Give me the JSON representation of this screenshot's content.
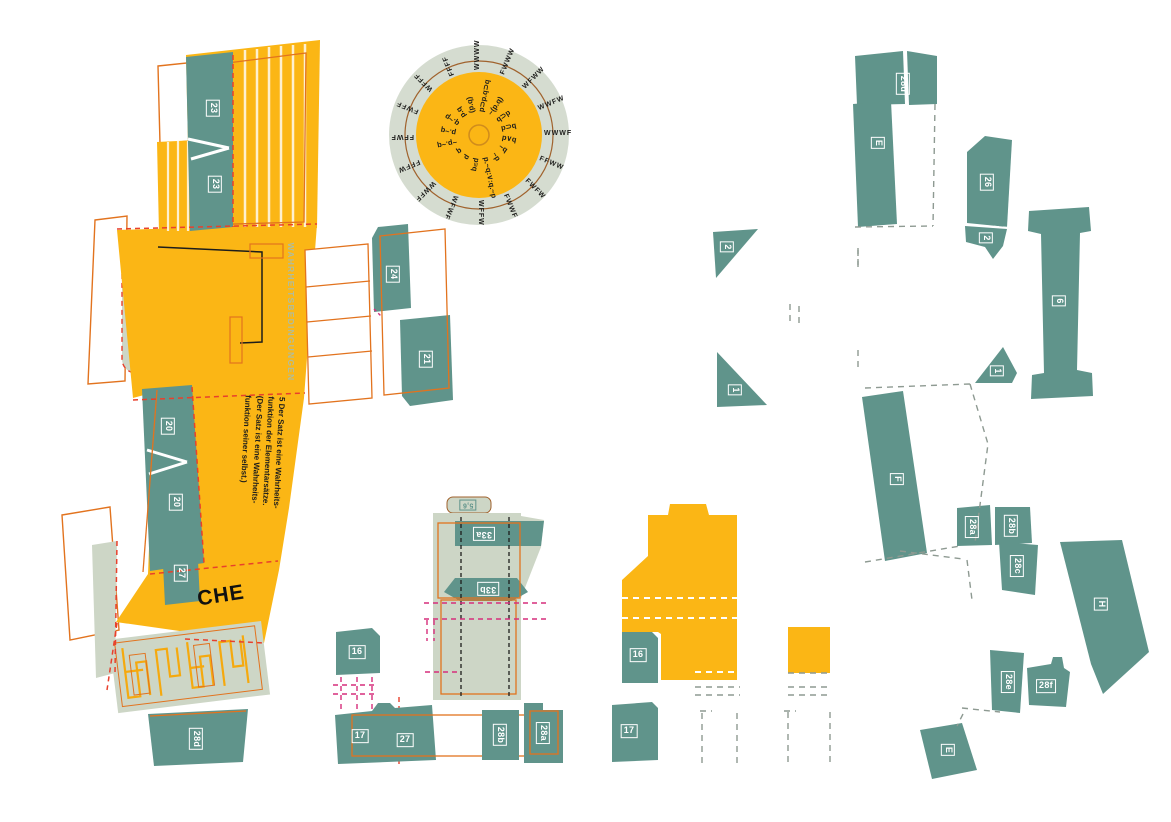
{
  "palette": {
    "yellow": "#FBB615",
    "teal": "#60948B",
    "sage_light": "#CDD6C6",
    "disc_sage": "#D5DCD0",
    "orange_line": "#E2731E",
    "red_dash": "#E8402C",
    "magenta_dash": "#D62E7B",
    "brown_ring": "#A0622D",
    "gray_dash": "#8E9A92",
    "black": "#1D1D1B"
  },
  "left_assembly": {
    "tab_23_top": "23",
    "tab_23_bottom": "23",
    "tab_24": "24",
    "tab_21": "21",
    "tab_20_top": "20",
    "tab_20_bottom": "20",
    "tab_27": "27",
    "tab_28d": "28d",
    "vertical_label": "WAHRHEITSBEDINGUNGEN",
    "fragment_text": "CHE",
    "tractatus_lines": [
      "5   Der Satz ist eine Wahrheits-",
      "funktion der Elementarsätze.",
      "(Der Satz ist eine Wahrheits-",
      "funktion seiner selbst.)"
    ]
  },
  "disc": {
    "ring_values": [
      "WWWW",
      "FWWW",
      "WFWW",
      "WWFW",
      "WWWF",
      "FFWW",
      "FWFW",
      "FWWF",
      "WFFW",
      "WFWF",
      "WWFF",
      "FFFW",
      "FFWF",
      "FWFF",
      "WFFF",
      "FFFF"
    ],
    "formulas": [
      "p⊃p.q⊃q",
      "~(p.q)",
      "q⊃p",
      "p⊃q",
      "p∨q",
      "~q",
      "~p",
      "p.~q:∨:q.~p",
      "p≡q",
      "p",
      "q",
      "~p.~q",
      "p.~q",
      "q.~p",
      "p.q",
      "(p.q)"
    ]
  },
  "center_piece": {
    "tab_5_6": "5,6",
    "tab_33a": "33a",
    "tab_33b": "33b"
  },
  "loose_tabs": {
    "tab_16": "16",
    "tab_17": "17",
    "tab_27": "27",
    "tab_28b": "28b",
    "tab_28a": "28a"
  },
  "yellow_piece": {
    "tab_16": "16",
    "tab_17": "17",
    "tab_triangle_2": "2",
    "tab_triangle_1": "1"
  },
  "right_pieces": {
    "tab_28d": "28d",
    "tab_e": "E",
    "tab_26": "26",
    "tab_2": "2",
    "tab_6": "6",
    "tab_1": "1",
    "tab_f": "F",
    "tab_28a": "28a",
    "tab_28b": "28b",
    "tab_28c": "28c",
    "tab_h": "H",
    "tab_28e": "28e",
    "tab_28f": "28f",
    "tab_e_bottom": "E"
  }
}
